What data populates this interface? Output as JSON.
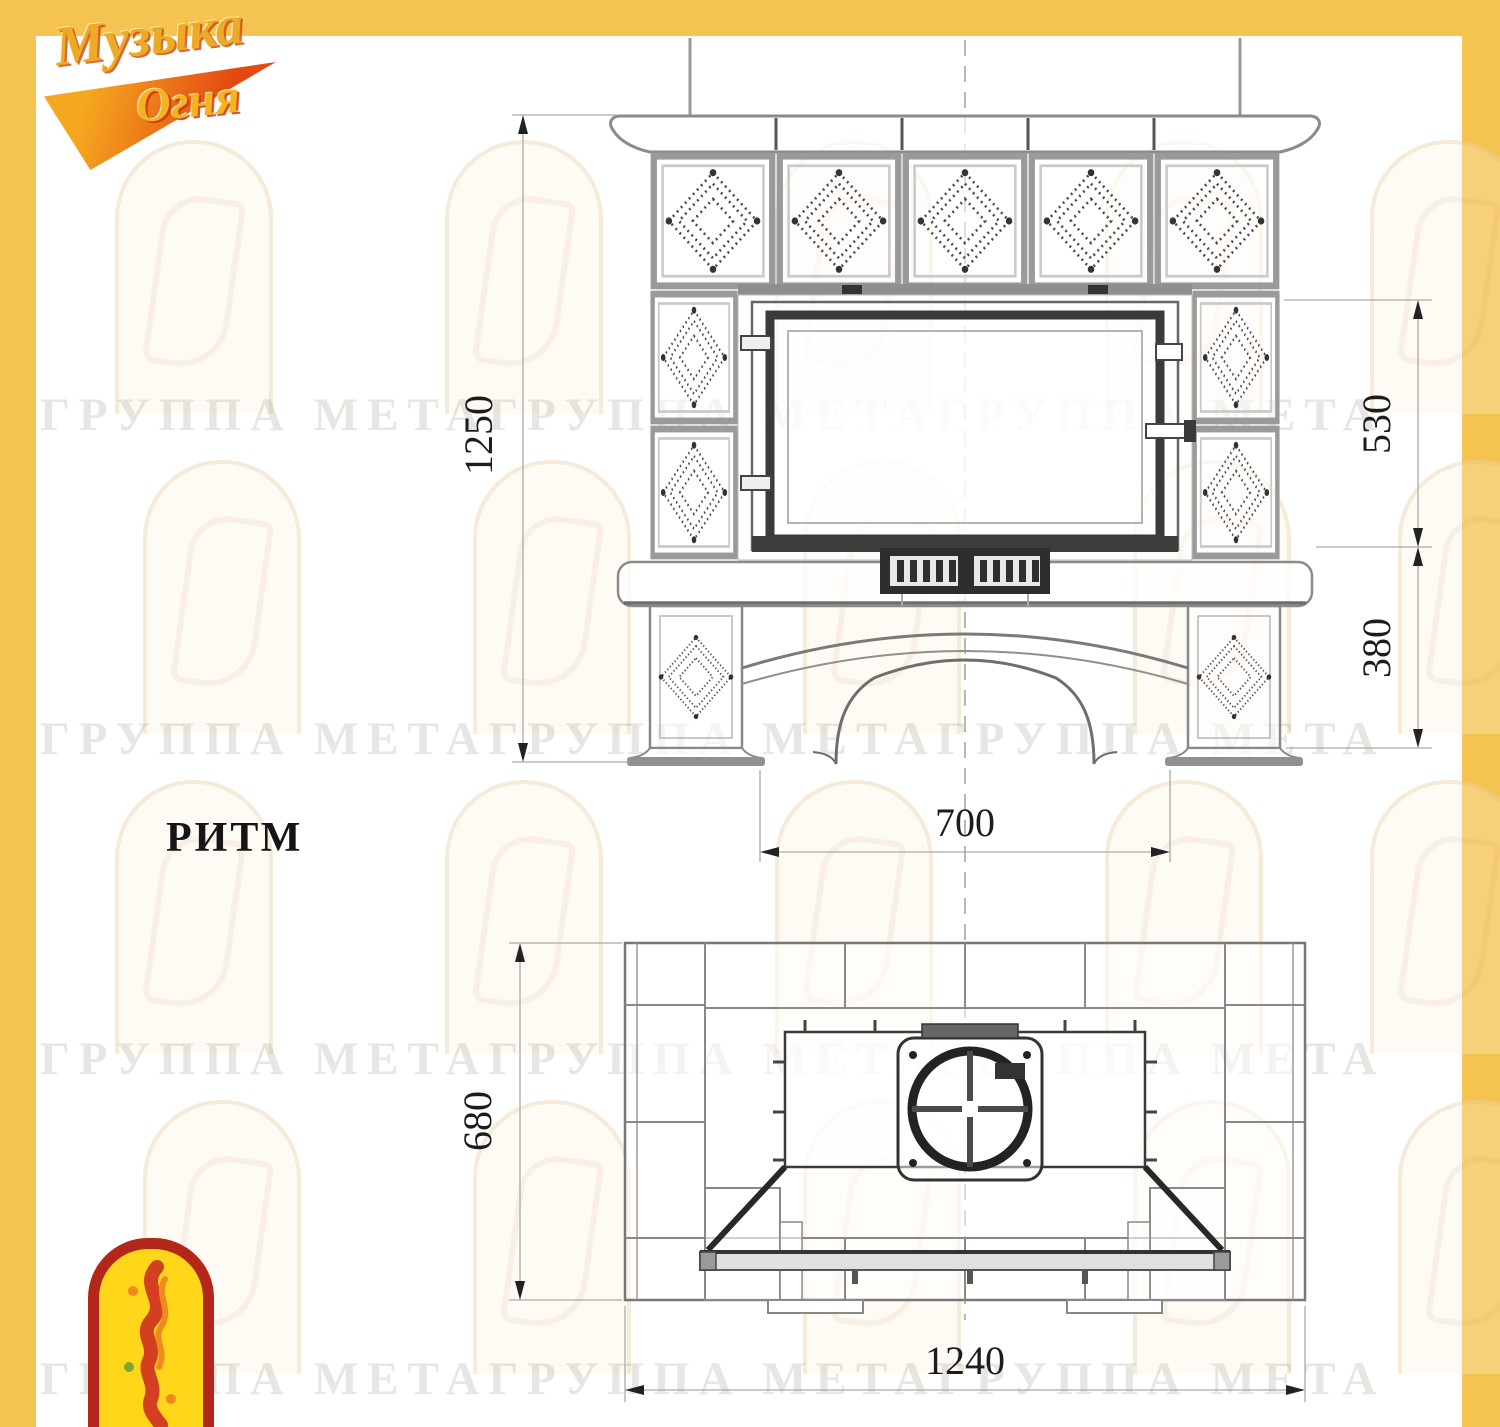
{
  "page": {
    "background": "#ffffff",
    "frame_color": "#F5C34F"
  },
  "brand": {
    "logo_word1": "Музыка",
    "logo_word2": "Огня",
    "gold": "#EDAA26",
    "red": "#CC2B1D",
    "emblem_yellow": "#FFD61A",
    "emblem_red": "#B3261A"
  },
  "watermark": {
    "text": "ГРУППА МЕТАГРУППА МЕТАГРУППА МЕТА"
  },
  "drawing": {
    "model_name": "РИТМ",
    "line_color": "#8a8a8a",
    "dark_color": "#3a3a3a",
    "front_view": {
      "dim_overall_height": "1250",
      "dim_firebox_height": "530",
      "dim_base_height": "380",
      "dim_opening_width": "700"
    },
    "plan_view": {
      "dim_depth": "680",
      "dim_width": "1240"
    }
  }
}
